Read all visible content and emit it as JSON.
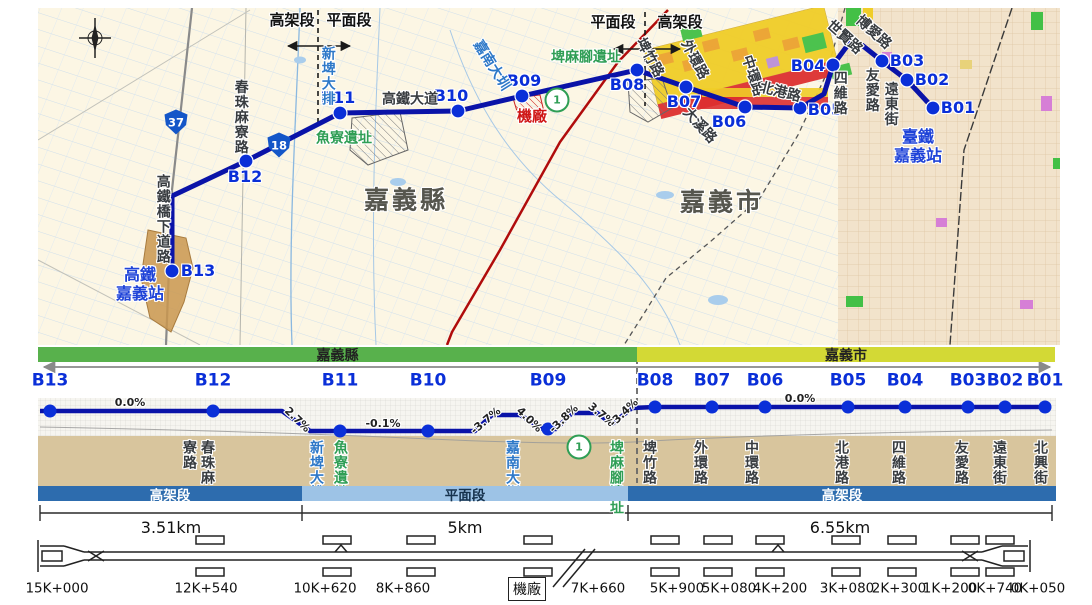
{
  "colors": {
    "route": "#0a13a8",
    "station": "#0a2fd8",
    "county_green": "#58b14c",
    "city_yellow": "#d3d935",
    "elevated_blue": "#2d6cae",
    "at_grade_blue": "#9dc3e6",
    "ground_tan": "#d8c59d",
    "water_blue": "#2d78c8",
    "heritage_green": "#2f9e55",
    "depot_red": "#cf1616"
  },
  "map": {
    "area_labels": [
      {
        "t": "嘉義縣"
      },
      {
        "t": "嘉義市"
      }
    ],
    "markers": [
      {
        "a": "高架段",
        "b": "平面段"
      },
      {
        "a": "平面段",
        "b": "高架段"
      }
    ],
    "poi_hsr": {
      "line1": "高鐵",
      "line2": "嘉義站"
    },
    "poi_tra": {
      "line1": "臺鐵",
      "line2": "嘉義站"
    },
    "route": "172,271 172,196 246,161 340,113 458,111 522,96 637,70 686,87 745,107 800,108 824,94 833,65 853,38 882,61 907,80 933,108",
    "stations": [
      {
        "id": "B01",
        "x": 933,
        "y": 108,
        "lx": 958,
        "ly": 108
      },
      {
        "id": "B02",
        "x": 907,
        "y": 80,
        "lx": 932,
        "ly": 80
      },
      {
        "id": "B03",
        "x": 882,
        "y": 61,
        "lx": 907,
        "ly": 61
      },
      {
        "id": "B04",
        "x": 833,
        "y": 65,
        "lx": 808,
        "ly": 66
      },
      {
        "id": "B05",
        "x": 800,
        "y": 108,
        "lx": 825,
        "ly": 110
      },
      {
        "id": "B06",
        "x": 745,
        "y": 107,
        "lx": 729,
        "ly": 122
      },
      {
        "id": "B07",
        "x": 686,
        "y": 87,
        "lx": 684,
        "ly": 102
      },
      {
        "id": "B08",
        "x": 637,
        "y": 70,
        "lx": 627,
        "ly": 85
      },
      {
        "id": "B09",
        "x": 522,
        "y": 96,
        "lx": 524,
        "ly": 81
      },
      {
        "id": "B10",
        "x": 458,
        "y": 111,
        "lx": 451,
        "ly": 96
      },
      {
        "id": "B11",
        "x": 340,
        "y": 113,
        "lx": 338,
        "ly": 98
      },
      {
        "id": "B12",
        "x": 246,
        "y": 161,
        "lx": 245,
        "ly": 177
      },
      {
        "id": "B13",
        "x": 172,
        "y": 271,
        "lx": 198,
        "ly": 271
      }
    ],
    "labels": [
      {
        "t": "高鐵大道",
        "x": 410,
        "y": 100,
        "cls": "road-dark",
        "rot": 0
      },
      {
        "t": "春珠麻寮路",
        "x": 240,
        "y": 117,
        "cls": "road-dark vert"
      },
      {
        "t": "高鐵橋下道路",
        "x": 162,
        "y": 219,
        "cls": "road-dark vert"
      },
      {
        "t": "新埤大排",
        "x": 327,
        "y": 76,
        "cls": "water vert"
      },
      {
        "t": "嘉南大圳",
        "x": 491,
        "y": 66,
        "cls": "water",
        "rot": 58
      },
      {
        "t": "魚寮遺址",
        "x": 344,
        "y": 139,
        "cls": "green"
      },
      {
        "t": "埤麻腳遺址",
        "x": 586,
        "y": 58,
        "cls": "green"
      },
      {
        "t": "機廠",
        "x": 532,
        "y": 116,
        "cls": "red"
      },
      {
        "t": "埤竹路",
        "x": 649,
        "y": 58,
        "cls": "road-dark",
        "rot": 62
      },
      {
        "t": "外環路",
        "x": 694,
        "y": 60,
        "cls": "road-dark",
        "rot": 62
      },
      {
        "t": "中環路",
        "x": 752,
        "y": 76,
        "cls": "road-dark",
        "rot": 72
      },
      {
        "t": "北港路",
        "x": 780,
        "y": 93,
        "cls": "road-dark",
        "rot": 14
      },
      {
        "t": "四維路",
        "x": 839,
        "y": 93,
        "cls": "road-dark vert"
      },
      {
        "t": "友愛路",
        "x": 871,
        "y": 90,
        "cls": "road-dark vert"
      },
      {
        "t": "遠東街",
        "x": 890,
        "y": 104,
        "cls": "road-dark vert"
      },
      {
        "t": "大溪路",
        "x": 699,
        "y": 126,
        "cls": "road-dark",
        "rot": 48
      },
      {
        "t": "世賢路",
        "x": 844,
        "y": 38,
        "cls": "road-dark",
        "rot": 42
      },
      {
        "t": "博愛路",
        "x": 873,
        "y": 33,
        "cls": "road-dark",
        "rot": 42
      }
    ],
    "shields": [
      {
        "n": "37",
        "x": 176,
        "y": 122,
        "cls": "sh-blue"
      },
      {
        "n": "18",
        "x": 279,
        "y": 145,
        "cls": "sh-blue"
      },
      {
        "n": "1",
        "x": 557,
        "y": 100,
        "cls": "sh-plum"
      }
    ]
  },
  "profile": {
    "county": [
      {
        "t": "嘉義縣"
      },
      {
        "t": "嘉義市"
      }
    ],
    "line": "40,411 213,411 282,411 310,431 475,431 492,415 520,415 543,429 556,429 572,413 597,413 612,424 632,408 655,407 1050,407",
    "stations": [
      {
        "id": "B13",
        "x": 50,
        "y": 411
      },
      {
        "id": "B12",
        "x": 213,
        "y": 411
      },
      {
        "id": "B11",
        "x": 340,
        "y": 431
      },
      {
        "id": "B10",
        "x": 428,
        "y": 431
      },
      {
        "id": "B09",
        "x": 548,
        "y": 429
      },
      {
        "id": "B08",
        "x": 655,
        "y": 407
      },
      {
        "id": "B07",
        "x": 712,
        "y": 407
      },
      {
        "id": "B06",
        "x": 765,
        "y": 407
      },
      {
        "id": "B05",
        "x": 848,
        "y": 407
      },
      {
        "id": "B04",
        "x": 905,
        "y": 407
      },
      {
        "id": "B03",
        "x": 968,
        "y": 407
      },
      {
        "id": "B02",
        "x": 1005,
        "y": 407
      },
      {
        "id": "B01",
        "x": 1045,
        "y": 407
      }
    ],
    "grades": [
      {
        "t": "0.0%",
        "x": 130,
        "y": 403,
        "rot": 0
      },
      {
        "t": "2.7%",
        "x": 297,
        "y": 420,
        "rot": 44
      },
      {
        "t": "-0.1%",
        "x": 383,
        "y": 424,
        "rot": 0
      },
      {
        "t": "-3.7%",
        "x": 486,
        "y": 421,
        "rot": -40
      },
      {
        "t": "4.0%",
        "x": 529,
        "y": 420,
        "rot": 44
      },
      {
        "t": "-3.8%",
        "x": 564,
        "y": 419,
        "rot": -44
      },
      {
        "t": "3.7%",
        "x": 601,
        "y": 415,
        "rot": 40
      },
      {
        "t": "-3.4%",
        "x": 624,
        "y": 413,
        "rot": -44
      },
      {
        "t": "0.0%",
        "x": 800,
        "y": 399,
        "rot": 0
      }
    ],
    "roads": [
      {
        "t": "春珠麻寮路",
        "cols": [
          "春珠麻",
          "寮路"
        ],
        "x": 198,
        "cls": "dark"
      },
      {
        "t": "新埤大排",
        "x": 316,
        "cls": "water"
      },
      {
        "t": "魚寮遺址",
        "x": 340,
        "cls": "green"
      },
      {
        "t": "嘉南大圳",
        "x": 512,
        "cls": "water"
      },
      {
        "t": "埤麻腳遺址",
        "x": 616,
        "cls": "green"
      },
      {
        "t": "埤竹路",
        "x": 649,
        "cls": "dark"
      },
      {
        "t": "外環路",
        "x": 700,
        "cls": "dark"
      },
      {
        "t": "中環路",
        "x": 751,
        "cls": "dark"
      },
      {
        "t": "北港路",
        "x": 841,
        "cls": "dark"
      },
      {
        "t": "四維路",
        "x": 898,
        "cls": "dark"
      },
      {
        "t": "友愛路",
        "x": 961,
        "cls": "dark"
      },
      {
        "t": "遠東街",
        "x": 999,
        "cls": "dark"
      },
      {
        "t": "北興街",
        "x": 1040,
        "cls": "dark"
      }
    ],
    "shield": {
      "n": "1",
      "x": 579,
      "y": 447
    },
    "bars": [
      {
        "t": "高架段",
        "x1": 38,
        "x2": 302,
        "type": "elev"
      },
      {
        "t": "平面段",
        "x1": 302,
        "x2": 628,
        "type": "grade"
      },
      {
        "t": "高架段",
        "x1": 628,
        "x2": 1056,
        "type": "elev"
      }
    ],
    "ruler": {
      "ticks": [
        40,
        302,
        628,
        1052
      ],
      "segs": [
        {
          "t": "3.51km",
          "cx": 171
        },
        {
          "t": "5km",
          "cx": 465
        },
        {
          "t": "6.55km",
          "cx": 840
        }
      ]
    }
  },
  "schematic": {
    "depot_label": "機廠",
    "platforms": [
      210,
      337,
      421,
      538,
      665,
      718,
      770,
      846,
      902,
      965,
      1000
    ],
    "turnouts": [
      341,
      778
    ],
    "chainages": [
      {
        "t": "15K+000",
        "x": 57
      },
      {
        "t": "12K+540",
        "x": 206
      },
      {
        "t": "10K+620",
        "x": 325
      },
      {
        "t": "8K+860",
        "x": 403
      },
      {
        "t": "7K+660",
        "x": 598
      },
      {
        "t": "5K+900",
        "x": 677
      },
      {
        "t": "5K+080",
        "x": 729
      },
      {
        "t": "4K+200",
        "x": 780
      },
      {
        "t": "3K+080",
        "x": 847
      },
      {
        "t": "2K+300",
        "x": 899
      },
      {
        "t": "1K+200",
        "x": 950
      },
      {
        "t": "0K+740",
        "x": 995
      },
      {
        "t": "0K+050",
        "x": 1038
      }
    ]
  }
}
